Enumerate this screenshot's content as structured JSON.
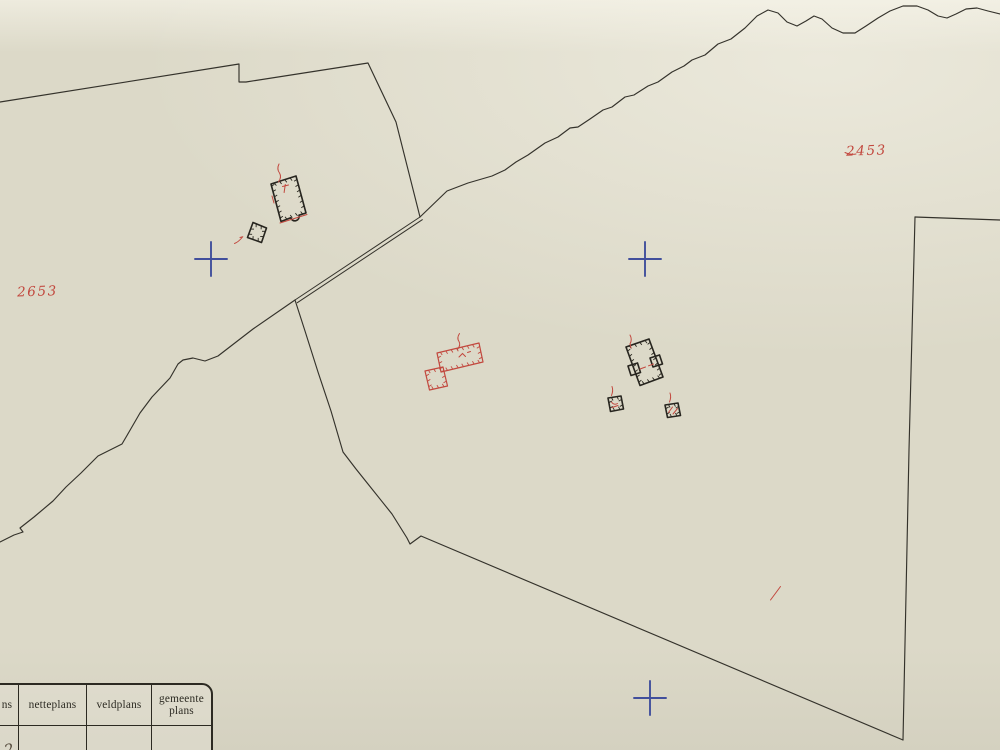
{
  "map": {
    "labels": {
      "parcel_left": "2653",
      "parcel_right": "2453"
    },
    "colors": {
      "paper": "#dcd9c8",
      "ink": "#34322b",
      "building_ink": "#27251f",
      "red": "#c2483e",
      "blue": "#414f9c"
    },
    "features": {
      "survey_cross_count": "3"
    }
  },
  "legend_table": {
    "headers": [
      "ns",
      "netteplans",
      "veldplans",
      "gemeente plans"
    ],
    "entry_mark": "2"
  }
}
